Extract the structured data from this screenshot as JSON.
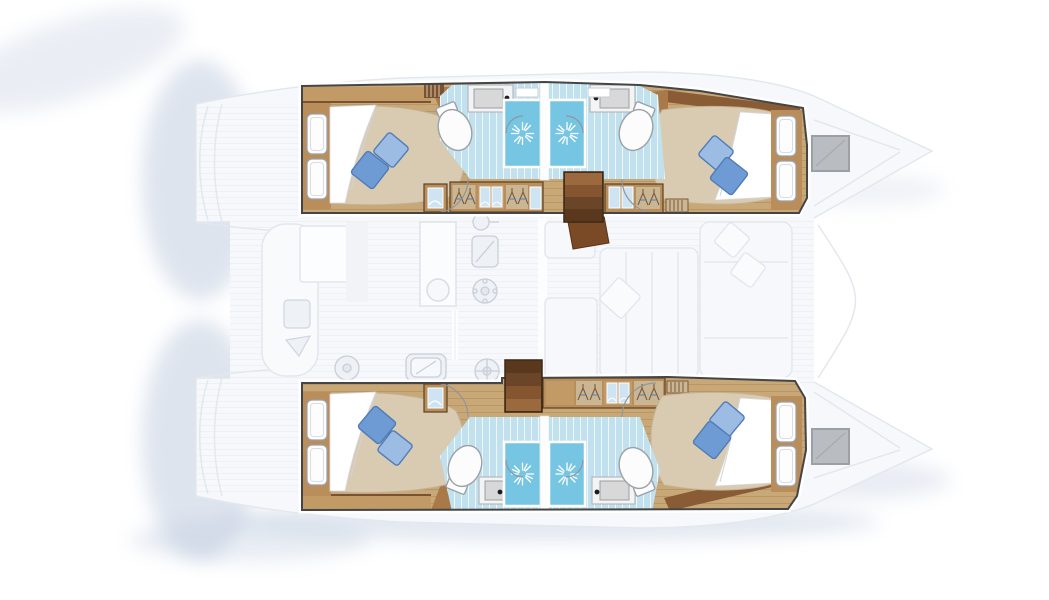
{
  "meta": {
    "title": "Catamaran yacht interior floor plan, top-down view",
    "description": "Four-cabin, four-bathroom sailing catamaran layout. Hull accommodations rendered in full colour; bridge-deck saloon, galley, cockpit and bows shown ghosted.",
    "orientation": "bow pointing right, stern on the left"
  },
  "palette": {
    "background": "#ffffff",
    "shadow": "#b7c5da",
    "ghost_fill": "#f6f8fb",
    "ghost_stroke": "#e3e8ee",
    "ghost_detail": "#cfd6e0",
    "outline": "#454545",
    "wood_floor": "#c9a878",
    "wood_mid": "#b98e5b",
    "wood_dark": "#8a5c36",
    "wood_light": "#c29a66",
    "tile_floor": "#c2e1ef",
    "shower_blue": "#76c5e2",
    "mattress": "#d9cbb2",
    "mattress_shade": "#c3b294",
    "sheet": "#ffffff",
    "pillow_light": "#9cbce4",
    "pillow_dark": "#6f9bd4",
    "pillow_edge": "#4f7cb8",
    "fixture_white": "#fcfcfc",
    "fixture_stroke": "#9aa0a6",
    "basin_gray": "#d8d8d8",
    "window_blue": "#cfe4f2",
    "hatch_gray": "#b9bdc2",
    "nav_desk_brown": "#7a4a26"
  },
  "boat": {
    "hulls": [
      {
        "id": "port-hull",
        "position": "top",
        "cabins": [
          {
            "name": "aft-cabin",
            "features": [
              "double-berth",
              "white-sheet",
              "two-blue-pillows",
              "slatted-headboard",
              "side-cabinet",
              "wardrobe-hangers",
              "wardrobe-windows",
              "vent-grill"
            ]
          },
          {
            "name": "forward-cabin",
            "features": [
              "double-berth",
              "white-sheet",
              "two-blue-pillows",
              "slatted-headboard",
              "wardrobe-windows",
              "wardrobe-hangers",
              "vent-grill"
            ]
          }
        ],
        "bathrooms": [
          {
            "name": "aft-bathroom",
            "features": [
              "vanity-sink",
              "toilet",
              "shower-cubicle",
              "door-swing"
            ]
          },
          {
            "name": "forward-bathroom",
            "features": [
              "vanity-sink",
              "toilet",
              "shower-cubicle",
              "door-swing"
            ]
          }
        ],
        "stairs": "companionway-steps"
      },
      {
        "id": "starboard-hull",
        "position": "bottom",
        "cabins": [
          {
            "name": "aft-cabin",
            "features": [
              "double-berth",
              "white-sheet",
              "two-blue-pillows",
              "slatted-headboard",
              "side-cabinet",
              "vent-grill"
            ]
          },
          {
            "name": "forward-cabin",
            "features": [
              "double-berth",
              "white-sheet",
              "two-blue-pillows",
              "slatted-headboard",
              "wardrobe-hangers",
              "wardrobe-windows",
              "vent-grill"
            ]
          }
        ],
        "bathrooms": [
          {
            "name": "aft-bathroom",
            "features": [
              "vanity-sink",
              "toilet",
              "shower-cubicle",
              "door-swing"
            ]
          },
          {
            "name": "forward-bathroom",
            "features": [
              "vanity-sink",
              "toilet",
              "shower-cubicle",
              "door-swing"
            ]
          }
        ],
        "stairs": "companionway-steps"
      }
    ],
    "deck_ghosted": {
      "features": [
        "saloon-table",
        "saloon-sofas",
        "seat-cushions",
        "galley-counter",
        "galley-sink",
        "stove-burner",
        "appliance-icons",
        "nav-station-desk",
        "cockpit-bench",
        "swim-platforms",
        "bow-deck-hatches",
        "foredeck"
      ]
    }
  }
}
